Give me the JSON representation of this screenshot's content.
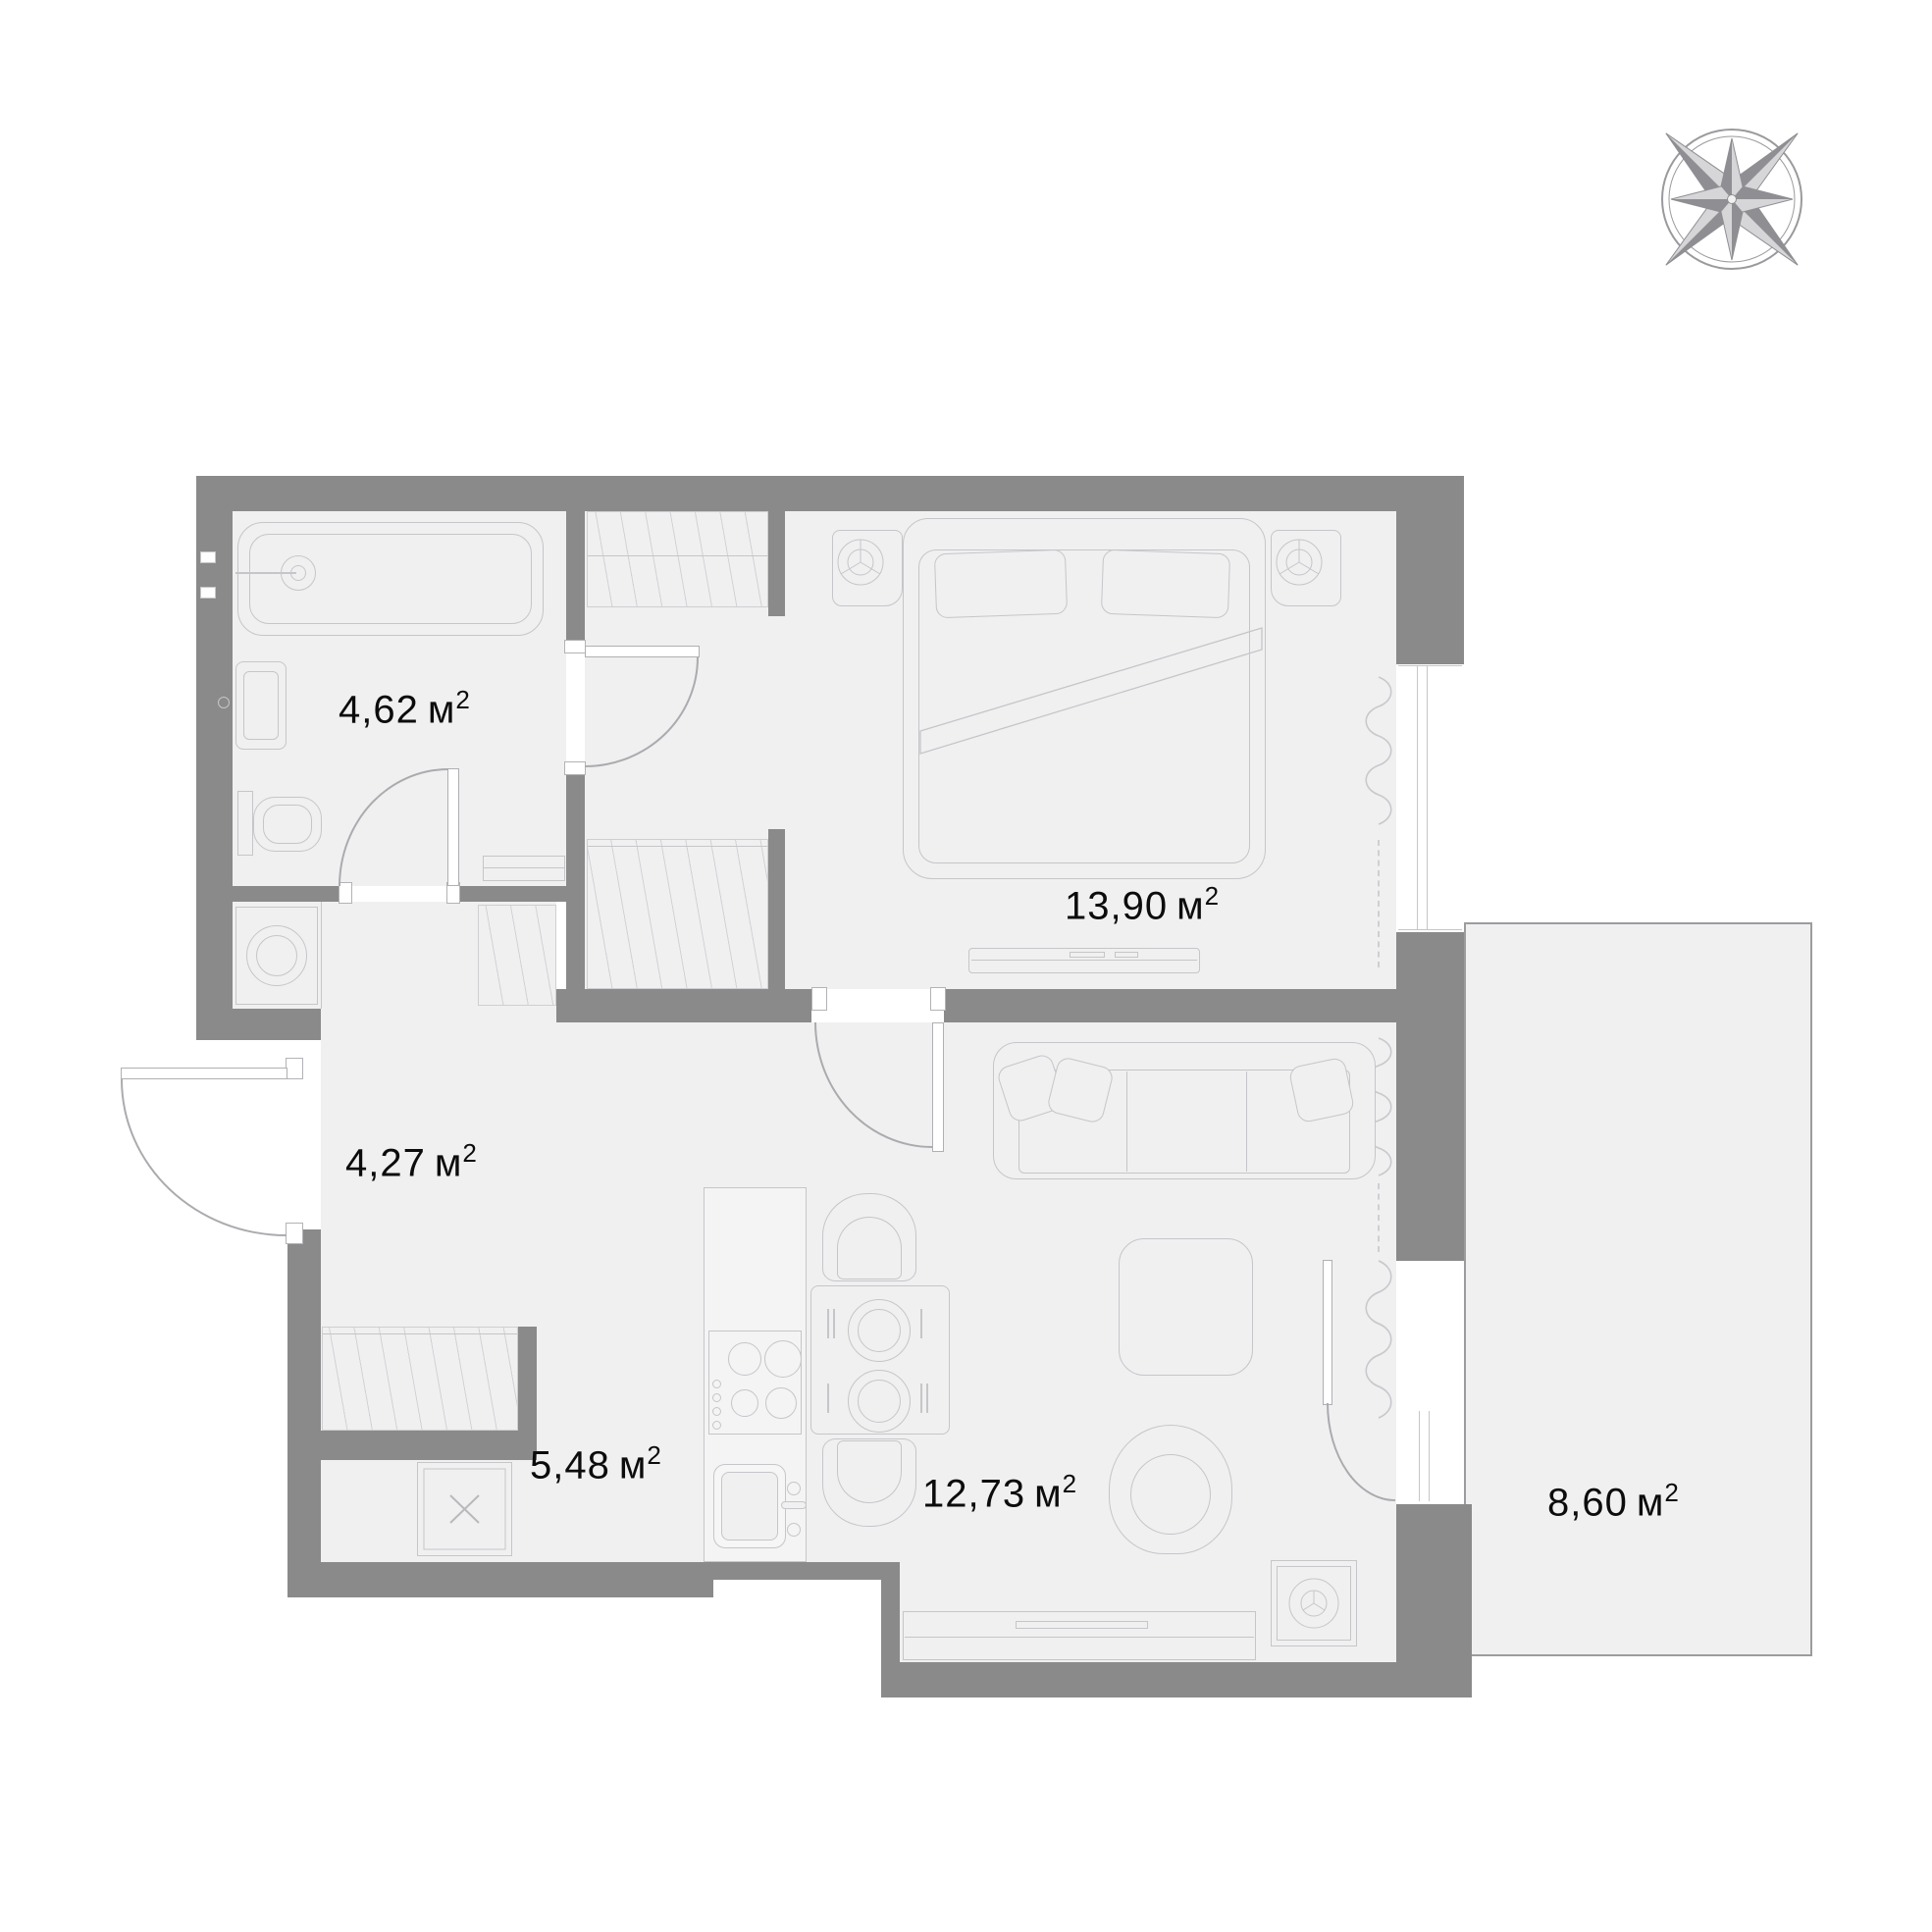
{
  "compass": {
    "north": "С",
    "east": "В",
    "south": "Ю",
    "west": "З"
  },
  "rooms": {
    "bathroom": {
      "value": "4,62",
      "unit": "м",
      "sup": "2"
    },
    "bedroom": {
      "value": "13,90",
      "unit": "м",
      "sup": "2"
    },
    "hallway": {
      "value": "4,27",
      "unit": "м",
      "sup": "2"
    },
    "kitchen": {
      "value": "5,48",
      "unit": "м",
      "sup": "2"
    },
    "living": {
      "value": "12,73",
      "unit": "м",
      "sup": "2"
    },
    "balcony": {
      "value": "8,60",
      "unit": "м",
      "sup": "2"
    }
  },
  "colors": {
    "wall": "#8a8a8a",
    "floor": "#f0f0f1",
    "furniture_line": "#c6c6ca"
  }
}
